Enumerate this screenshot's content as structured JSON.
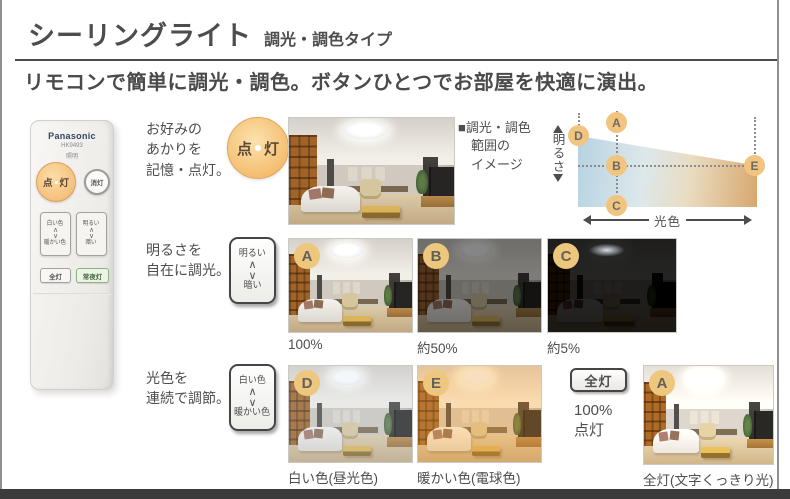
{
  "page": {
    "title": "シーリングライト",
    "title_type": "調光・調色タイプ",
    "subtitle": "リモコンで簡単に調光・調色。ボタンひとつでお部屋を快適に演出。"
  },
  "remote": {
    "brand": "Panasonic",
    "model": "HK9493",
    "model_label": "照明",
    "power_on_chars": [
      "点",
      "灯"
    ],
    "power_off": "消灯",
    "color_up": "白い色",
    "color_down": "暖かい色",
    "bright_up": "明るい",
    "bright_down": "暗い",
    "all_on": "全灯",
    "night_light": "常夜灯",
    "chevron_up": "∧",
    "chevron_down": "∨"
  },
  "sections": {
    "memory": {
      "label": "お好みの\nあかりを\n記憶・点灯。",
      "button_chars": [
        "点",
        "灯"
      ]
    },
    "brightness": {
      "label": "明るさを\n自在に調光。",
      "button_top": "明るい",
      "button_bottom": "暗い"
    },
    "color": {
      "label": "光色を\n連続で調節。",
      "button_top": "白い色",
      "button_bottom": "暖かい色",
      "all_button": "全灯",
      "all_note": "100%\n点灯"
    }
  },
  "diagram": {
    "legend": "■調光・調色\n　範囲の\n　イメージ",
    "y_label": "明るさ",
    "x_label": "光色",
    "points": {
      "a": "A",
      "b": "B",
      "c": "C",
      "d": "D",
      "e": "E"
    }
  },
  "gallery": [
    {
      "badge": "",
      "caption": "",
      "variant": "normal"
    },
    {
      "badge": "A",
      "caption": "100%",
      "variant": "normal"
    },
    {
      "badge": "B",
      "caption": "約50%",
      "variant": "half"
    },
    {
      "badge": "C",
      "caption": "約5%",
      "variant": "dim"
    },
    {
      "badge": "D",
      "caption": "白い色(昼光色)",
      "variant": "cool"
    },
    {
      "badge": "E",
      "caption": "暖かい色(電球色)",
      "variant": "warm"
    },
    {
      "badge": "A",
      "caption": "全灯(文字くっきり光)",
      "variant": "full"
    }
  ],
  "colors": {
    "badge": "#eec77e",
    "on_button": "#f4bc6d",
    "text": "#4d4d4d",
    "bottom_bar": "#3b3b3b",
    "gradient_cool": "#b5d2e2",
    "gradient_warm": "#d7a76d"
  }
}
